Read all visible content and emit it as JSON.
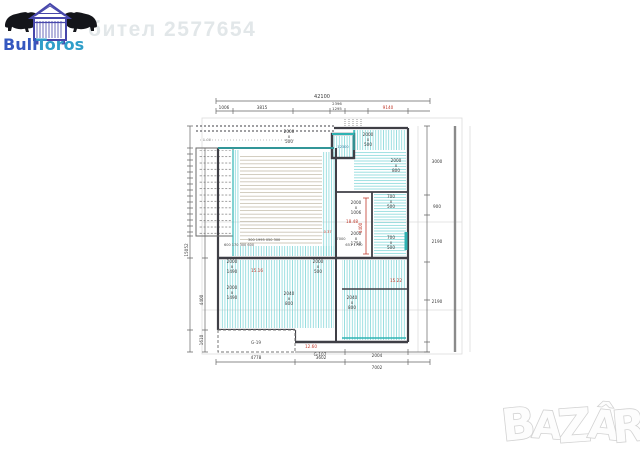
{
  "watermark": {
    "user_text": "бител 2577654"
  },
  "logo": {
    "brand_bull": "Bull",
    "brand_toros": "Toros"
  },
  "bazar": {
    "l1": "B",
    "l2": "A",
    "l3": "Z",
    "l4": "Â",
    "l5": "R"
  },
  "plan": {
    "x_char": "x",
    "dims": {
      "total_width": "42100",
      "top": [
        "1006",
        "3815",
        "2396",
        "1295",
        "9140"
      ],
      "bottom": [
        "4778",
        "3602",
        "2004",
        "7002"
      ],
      "left": [
        "15052",
        "4400",
        "1610"
      ],
      "right": [
        "3000",
        "900",
        "2190",
        "2190"
      ]
    },
    "windows": [
      {
        "w": "2000",
        "h": "500"
      },
      {
        "w": "2000",
        "h": "500"
      },
      {
        "w": "2000",
        "h": "800"
      },
      {
        "w": "2000",
        "h": "1006"
      },
      {
        "w": "2000",
        "h": "1750"
      },
      {
        "w": "700",
        "h": "500"
      },
      {
        "w": "700",
        "h": "500"
      },
      {
        "w": "2000",
        "h": "1490"
      },
      {
        "w": "2000",
        "h": "1490"
      },
      {
        "w": "2040",
        "h": "800"
      },
      {
        "w": "2000",
        "h": "500"
      },
      {
        "w": "2040",
        "h": "800"
      }
    ],
    "red_marks": {
      "r1": "18.48",
      "r2": "15.16",
      "r3": "15.22",
      "r4": "12.60",
      "r5": "4400",
      "r6": "-0.37"
    },
    "areas": {
      "a1": "G-19",
      "a2": "G-107",
      "a3": "12300",
      "a4": "1-00",
      "a5": "7000",
      "a6": "651 1700"
    },
    "notes": {
      "row1": "300 1995 050 300",
      "row2": "600 170 300 600"
    }
  }
}
